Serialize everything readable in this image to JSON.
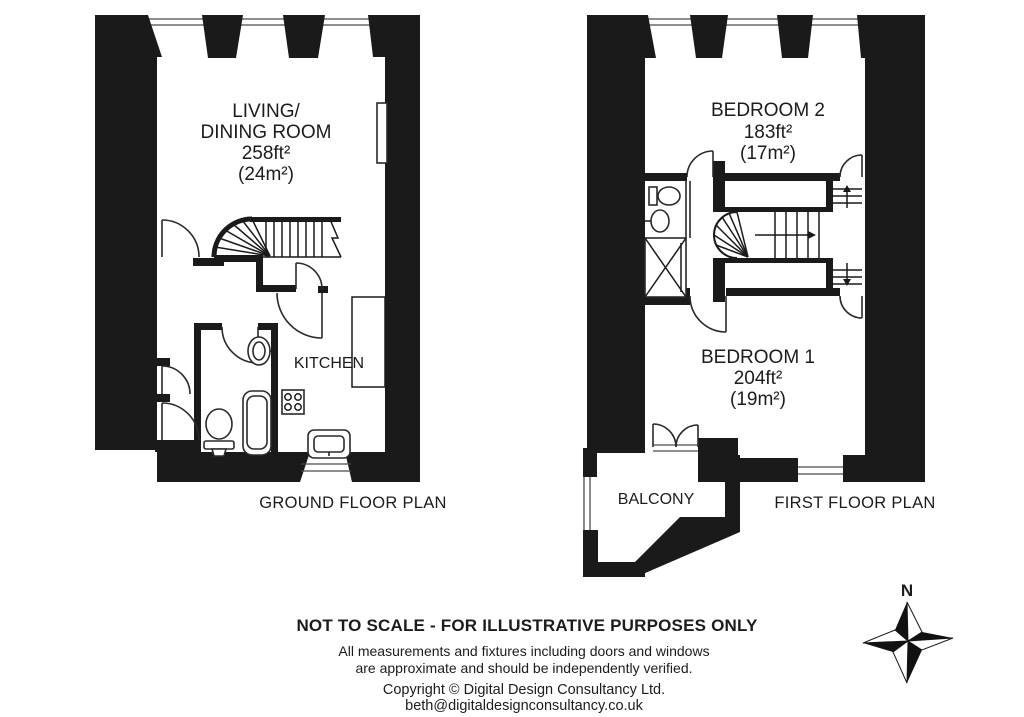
{
  "ground_floor": {
    "caption": "GROUND FLOOR PLAN",
    "living_dining": {
      "line1": "LIVING/",
      "line2": "DINING ROOM",
      "area_ft": "258ft²",
      "area_m": "(24m²)"
    },
    "kitchen": {
      "name": "KITCHEN"
    }
  },
  "first_floor": {
    "caption": "FIRST FLOOR PLAN",
    "bedroom_2": {
      "name": "BEDROOM 2",
      "area_ft": "183ft²",
      "area_m": "(17m²)"
    },
    "bedroom_1": {
      "name": "BEDROOM 1",
      "area_ft": "204ft²",
      "area_m": "(19m²)"
    },
    "balcony": {
      "name": "BALCONY"
    }
  },
  "footer": {
    "disclaimer": "NOT TO SCALE - FOR ILLUSTRATIVE PURPOSES ONLY",
    "note_line1": "All measurements and fixtures including doors and windows",
    "note_line2": "are approximate and should be independently verified.",
    "copyright": "Copyright © Digital Design Consultancy Ltd.",
    "email": "beth@digitaldesignconsultancy.co.uk"
  },
  "compass": {
    "north_label": "N"
  },
  "colors": {
    "wall": "#1a1a1a",
    "background": "#ffffff"
  }
}
